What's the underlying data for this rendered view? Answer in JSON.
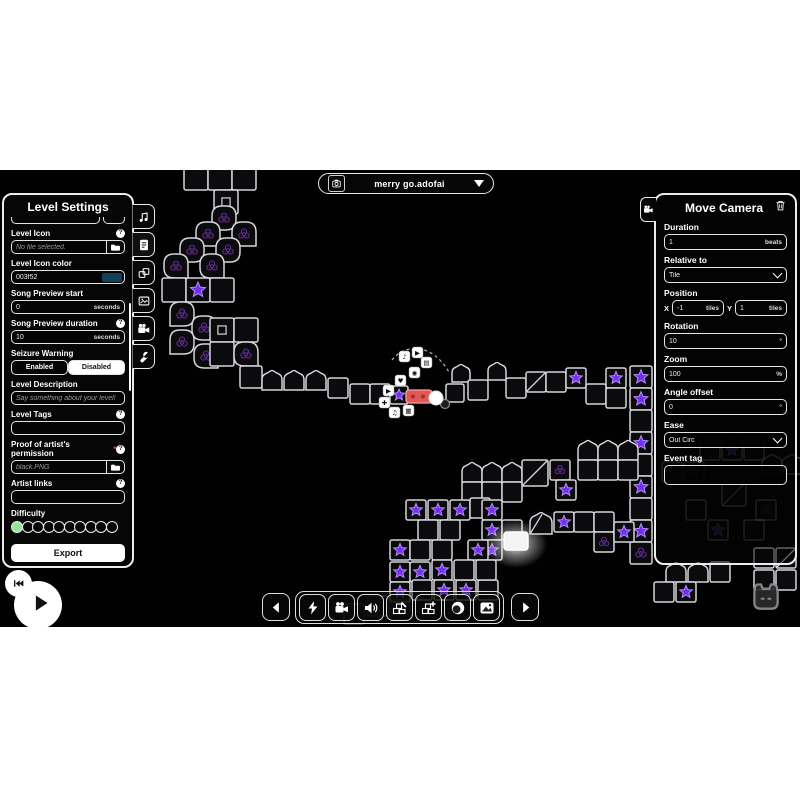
{
  "filebar": {
    "filename": "merry go.adofai",
    "icon": "camera-capture-icon",
    "dropdown_icon": "dropdown-triangle-icon"
  },
  "level_settings": {
    "title": "Level Settings",
    "tabs": [
      {
        "icon": "music-note-icon"
      },
      {
        "icon": "file-text-icon",
        "active": true
      },
      {
        "icon": "decorations-icon"
      },
      {
        "icon": "image-icon"
      },
      {
        "icon": "video-camera-icon"
      },
      {
        "icon": "wrench-icon"
      }
    ],
    "fields": [
      {
        "label": "Level Icon",
        "help": true,
        "type": "file",
        "value": "No file selected.",
        "icon": "folder-icon"
      },
      {
        "label": "Level Icon color",
        "type": "color",
        "value": "003f52",
        "swatch": "#0e4256"
      },
      {
        "label": "Song Preview start",
        "type": "unit",
        "value": "0",
        "unit": "seconds"
      },
      {
        "label": "Song Preview duration",
        "help": true,
        "type": "unit",
        "value": "10",
        "unit": "seconds"
      },
      {
        "label": "Seizure Warning",
        "type": "toggle",
        "options": [
          "Enabled",
          "Disabled"
        ],
        "selected": "Disabled"
      },
      {
        "label": "Level Description",
        "type": "text",
        "placeholder": "Say something about your level!"
      },
      {
        "label": "Level Tags",
        "help": true,
        "type": "text",
        "value": ""
      },
      {
        "label": "Proof of artist's permission",
        "required": true,
        "help": true,
        "type": "file",
        "value": "black.PNG",
        "icon": "folder-icon"
      },
      {
        "label": "Artist links",
        "help": true,
        "type": "text",
        "value": ""
      }
    ],
    "difficulty": {
      "label": "Difficulty",
      "total": 10,
      "filled": 1,
      "fill_color": "#93e59d"
    },
    "export_label": "Export"
  },
  "move_camera": {
    "title": "Move Camera",
    "tab_icon": "video-camera-icon",
    "delete_icon": "trash-icon",
    "fields": [
      {
        "label": "Duration",
        "type": "unit",
        "value": "1",
        "unit": "beats"
      },
      {
        "label": "Relative to",
        "type": "select",
        "value": "Tile"
      },
      {
        "label": "Position",
        "type": "xy",
        "x": {
          "prefix": "X",
          "value": "-1",
          "unit": "tiles"
        },
        "y": {
          "prefix": "Y",
          "value": "1",
          "unit": "tiles"
        }
      },
      {
        "label": "Rotation",
        "type": "unit",
        "value": "10",
        "unit": "°"
      },
      {
        "label": "Zoom",
        "type": "unit",
        "value": "100",
        "unit": "%"
      },
      {
        "label": "Angle offset",
        "type": "unit",
        "value": "0",
        "unit": "°"
      },
      {
        "label": "Ease",
        "type": "select",
        "value": "Out Circ"
      },
      {
        "label": "Event tag",
        "type": "text",
        "value": ""
      }
    ]
  },
  "toolbar": {
    "prev": {
      "icon": "prev-arrow-icon"
    },
    "group": [
      {
        "icon": "lightning-icon"
      },
      {
        "icon": "video-camera-icon"
      },
      {
        "icon": "speaker-icon"
      },
      {
        "icon": "decoration-edit-icon"
      },
      {
        "icon": "decoration-add-icon"
      },
      {
        "icon": "planet-icon"
      },
      {
        "icon": "image-filter-icon"
      }
    ],
    "next": {
      "icon": "next-arrow-icon"
    }
  },
  "transport": {
    "rewind_icon": "skip-start-icon",
    "play_icon": "play-icon"
  },
  "auto_cat_icon": "auto-cat-icon",
  "misc": {
    "help_glyph": "?",
    "required_glyph": "*"
  },
  "track": {
    "tile_stroke": "#d6d6da",
    "tile_fill": "#0b0b0e",
    "star_fill": "#7430e8",
    "star_stroke": "#b38cff",
    "tiles": [
      {
        "t": "sq",
        "x": 184,
        "y": 166,
        "s": 24
      },
      {
        "t": "sq",
        "x": 208,
        "y": 166,
        "s": 24
      },
      {
        "t": "sq",
        "x": 232,
        "y": 166,
        "s": 24
      },
      {
        "t": "sqi",
        "x": 214,
        "y": 190,
        "s": 24
      },
      {
        "t": "tr",
        "x": 212,
        "y": 206,
        "s": 24,
        "d": "bl"
      },
      {
        "t": "tr",
        "x": 232,
        "y": 222,
        "s": 24,
        "d": "br"
      },
      {
        "t": "tr",
        "x": 196,
        "y": 222,
        "s": 24,
        "d": "br"
      },
      {
        "t": "tr",
        "x": 216,
        "y": 238,
        "s": 24,
        "d": "bl"
      },
      {
        "t": "tr",
        "x": 180,
        "y": 238,
        "s": 24,
        "d": "bl"
      },
      {
        "t": "tr",
        "x": 200,
        "y": 254,
        "s": 24,
        "d": "br"
      },
      {
        "t": "tr",
        "x": 164,
        "y": 254,
        "s": 24,
        "d": "br"
      },
      {
        "t": "sq",
        "x": 162,
        "y": 278,
        "s": 24
      },
      {
        "t": "starsq",
        "x": 186,
        "y": 278,
        "s": 24
      },
      {
        "t": "sq",
        "x": 210,
        "y": 278,
        "s": 24
      },
      {
        "t": "tr",
        "x": 170,
        "y": 302,
        "s": 24,
        "d": "bl"
      },
      {
        "t": "tr",
        "x": 192,
        "y": 316,
        "s": 24,
        "d": "br"
      },
      {
        "t": "tr",
        "x": 170,
        "y": 330,
        "s": 24,
        "d": "bl"
      },
      {
        "t": "tr",
        "x": 194,
        "y": 344,
        "s": 24,
        "d": "br"
      },
      {
        "t": "sqi",
        "x": 210,
        "y": 318,
        "s": 24
      },
      {
        "t": "sq",
        "x": 234,
        "y": 318,
        "s": 24
      },
      {
        "t": "sq",
        "x": 210,
        "y": 342,
        "s": 24
      },
      {
        "t": "tr",
        "x": 234,
        "y": 342,
        "s": 24,
        "d": "br"
      },
      {
        "t": "sq",
        "x": 240,
        "y": 366,
        "s": 22
      },
      {
        "t": "arch",
        "x": 262,
        "y": 370
      },
      {
        "t": "arch",
        "x": 284,
        "y": 370
      },
      {
        "t": "arch",
        "x": 306,
        "y": 370
      },
      {
        "t": "sq",
        "x": 328,
        "y": 378
      },
      {
        "t": "sq",
        "x": 350,
        "y": 384
      },
      {
        "t": "sq",
        "x": 370,
        "y": 384
      },
      {
        "t": "starsq",
        "x": 390,
        "y": 386,
        "s": 18
      },
      {
        "t": "sq",
        "x": 446,
        "y": 384,
        "s": 18
      },
      {
        "t": "arch",
        "x": 452,
        "y": 364,
        "s": 18
      },
      {
        "t": "sq",
        "x": 468,
        "y": 380
      },
      {
        "t": "arch",
        "x": 488,
        "y": 362,
        "s": 18
      },
      {
        "t": "sq",
        "x": 506,
        "y": 378
      },
      {
        "t": "diag",
        "x": 526,
        "y": 372
      },
      {
        "t": "sq",
        "x": 546,
        "y": 372
      },
      {
        "t": "starsq",
        "x": 566,
        "y": 368
      },
      {
        "t": "sq",
        "x": 586,
        "y": 384
      },
      {
        "t": "starsq",
        "x": 606,
        "y": 368
      },
      {
        "t": "sq",
        "x": 606,
        "y": 388
      },
      {
        "t": "starsq",
        "x": 630,
        "y": 366,
        "s": 22
      },
      {
        "t": "starsq",
        "x": 630,
        "y": 388,
        "s": 22
      },
      {
        "t": "sq",
        "x": 630,
        "y": 410,
        "s": 22
      },
      {
        "t": "starsq",
        "x": 630,
        "y": 432,
        "s": 22
      },
      {
        "t": "sq",
        "x": 630,
        "y": 454,
        "s": 22
      },
      {
        "t": "starsq",
        "x": 630,
        "y": 476,
        "s": 22
      },
      {
        "t": "sq",
        "x": 630,
        "y": 498,
        "s": 22
      },
      {
        "t": "starsq",
        "x": 630,
        "y": 520,
        "s": 22
      },
      {
        "t": "rosesq",
        "x": 630,
        "y": 542,
        "s": 22
      },
      {
        "t": "arch",
        "x": 462,
        "y": 462
      },
      {
        "t": "arch",
        "x": 482,
        "y": 462
      },
      {
        "t": "arch",
        "x": 502,
        "y": 462
      },
      {
        "t": "sq",
        "x": 462,
        "y": 482
      },
      {
        "t": "sq",
        "x": 482,
        "y": 482
      },
      {
        "t": "sq",
        "x": 502,
        "y": 482
      },
      {
        "t": "diag",
        "x": 522,
        "y": 460,
        "s": 26
      },
      {
        "t": "rosesq",
        "x": 550,
        "y": 460
      },
      {
        "t": "starsq",
        "x": 556,
        "y": 480
      },
      {
        "t": "arch",
        "x": 578,
        "y": 440
      },
      {
        "t": "arch",
        "x": 598,
        "y": 440
      },
      {
        "t": "arch",
        "x": 618,
        "y": 440
      },
      {
        "t": "sq",
        "x": 578,
        "y": 460
      },
      {
        "t": "sq",
        "x": 598,
        "y": 460
      },
      {
        "t": "sq",
        "x": 618,
        "y": 460
      },
      {
        "t": "starsq",
        "x": 406,
        "y": 500
      },
      {
        "t": "starsq",
        "x": 428,
        "y": 500
      },
      {
        "t": "starsq",
        "x": 450,
        "y": 500
      },
      {
        "t": "sq",
        "x": 470,
        "y": 498
      },
      {
        "t": "sq",
        "x": 418,
        "y": 520
      },
      {
        "t": "sq",
        "x": 440,
        "y": 520
      },
      {
        "t": "starsq",
        "x": 482,
        "y": 500
      },
      {
        "t": "starsq",
        "x": 482,
        "y": 520
      },
      {
        "t": "starsq",
        "x": 482,
        "y": 540
      },
      {
        "t": "sq",
        "x": 502,
        "y": 520
      },
      {
        "t": "glow",
        "x": 504,
        "y": 532,
        "s": 24
      },
      {
        "t": "archdiag",
        "x": 530,
        "y": 512,
        "s": 22
      },
      {
        "t": "starsq",
        "x": 554,
        "y": 512
      },
      {
        "t": "sq",
        "x": 574,
        "y": 512
      },
      {
        "t": "sq",
        "x": 594,
        "y": 512
      },
      {
        "t": "rosesq",
        "x": 594,
        "y": 532
      },
      {
        "t": "starsq",
        "x": 614,
        "y": 522
      },
      {
        "t": "starsq",
        "x": 390,
        "y": 540
      },
      {
        "t": "starsq",
        "x": 390,
        "y": 562
      },
      {
        "t": "starsq",
        "x": 390,
        "y": 582
      },
      {
        "t": "sq",
        "x": 410,
        "y": 540
      },
      {
        "t": "starsq",
        "x": 410,
        "y": 562
      },
      {
        "t": "sq",
        "x": 432,
        "y": 540
      },
      {
        "t": "starsq",
        "x": 432,
        "y": 560
      },
      {
        "t": "starsq",
        "x": 468,
        "y": 540
      },
      {
        "t": "sq",
        "x": 412,
        "y": 580
      },
      {
        "t": "starsq",
        "x": 434,
        "y": 580
      },
      {
        "t": "starsq",
        "x": 456,
        "y": 580
      },
      {
        "t": "sq",
        "x": 478,
        "y": 580
      },
      {
        "t": "sq",
        "x": 454,
        "y": 560
      },
      {
        "t": "sq",
        "x": 476,
        "y": 560
      },
      {
        "t": "sq",
        "x": 700,
        "y": 440,
        "dim": 1
      },
      {
        "t": "starsq",
        "x": 722,
        "y": 440,
        "dim": 1
      },
      {
        "t": "sq",
        "x": 744,
        "y": 440,
        "dim": 1
      },
      {
        "t": "arch",
        "x": 762,
        "y": 454,
        "dim": 1
      },
      {
        "t": "arch",
        "x": 782,
        "y": 454,
        "dim": 1
      },
      {
        "t": "starsq",
        "x": 684,
        "y": 462,
        "dim": 1
      },
      {
        "t": "sq",
        "x": 662,
        "y": 462,
        "dim": 1
      },
      {
        "t": "diag",
        "x": 722,
        "y": 482,
        "s": 24,
        "dim": 1
      },
      {
        "t": "sq",
        "x": 686,
        "y": 500,
        "dim": 1
      },
      {
        "t": "rosesq",
        "x": 756,
        "y": 500,
        "dim": 1
      },
      {
        "t": "starsq",
        "x": 708,
        "y": 520,
        "dim": 1
      },
      {
        "t": "sq",
        "x": 744,
        "y": 520,
        "dim": 1
      },
      {
        "t": "arch",
        "x": 666,
        "y": 562
      },
      {
        "t": "arch",
        "x": 688,
        "y": 562
      },
      {
        "t": "sq",
        "x": 710,
        "y": 562
      },
      {
        "t": "sq",
        "x": 654,
        "y": 582
      },
      {
        "t": "starsq",
        "x": 676,
        "y": 582
      },
      {
        "t": "sq",
        "x": 754,
        "y": 548
      },
      {
        "t": "diag",
        "x": 776,
        "y": 548
      },
      {
        "t": "sq",
        "x": 754,
        "y": 570
      },
      {
        "t": "sq",
        "x": 776,
        "y": 570
      },
      {
        "t": "sq",
        "x": 368,
        "y": 596,
        "dim": 1
      },
      {
        "t": "starsq",
        "x": 390,
        "y": 600,
        "dim": 1
      },
      {
        "t": "sq",
        "x": 344,
        "y": 604,
        "dim": 1
      }
    ]
  },
  "playhead": {
    "red_tile": {
      "x": 406,
      "y": 390,
      "w": 26,
      "h": 13,
      "fill": "#e05858",
      "stroke": "#ff9e9e"
    },
    "ball": {
      "cx": 436,
      "cy": 398,
      "r": 7
    },
    "ball2": {
      "cx": 445,
      "cy": 404,
      "r": 4.5
    },
    "dash_path": "M392,360 C406,342 434,344 450,374",
    "badges": [
      {
        "x": 399,
        "y": 351,
        "g": "♪"
      },
      {
        "x": 412,
        "y": 347,
        "g": "▶"
      },
      {
        "x": 421,
        "y": 357,
        "g": "▤"
      },
      {
        "x": 409,
        "y": 367,
        "g": "◉"
      },
      {
        "x": 395,
        "y": 375,
        "g": "♥"
      },
      {
        "x": 383,
        "y": 385,
        "g": "▶"
      },
      {
        "x": 379,
        "y": 397,
        "g": "✚"
      },
      {
        "x": 389,
        "y": 407,
        "g": "♫"
      },
      {
        "x": 403,
        "y": 405,
        "g": "▦"
      }
    ]
  }
}
